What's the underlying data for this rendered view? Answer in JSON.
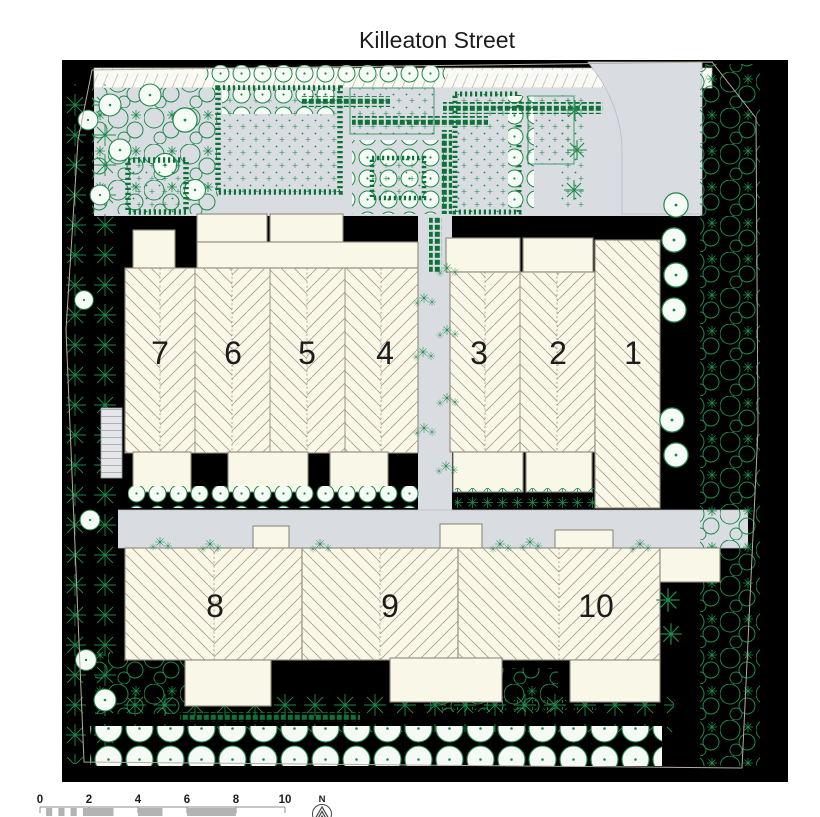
{
  "title": "Killeaton Street",
  "units": [
    "1",
    "2",
    "3",
    "4",
    "5",
    "6",
    "7",
    "8",
    "9",
    "10"
  ],
  "scale_bar": {
    "labels": [
      "0",
      "2",
      "4",
      "6",
      "8",
      "10"
    ]
  },
  "north": {
    "label": "N",
    "icon": "north-arrow-icon"
  },
  "colors": {
    "green": "#1d8a4b",
    "hedge": "#0d7239",
    "site": "#edf4ee",
    "road": "#d9dde2",
    "cream": "#f9f7e8",
    "outline": "#8f897a",
    "hatch": "#a79e88",
    "ink": "#1c1c1c",
    "scalegray": "#b3b3b3"
  }
}
